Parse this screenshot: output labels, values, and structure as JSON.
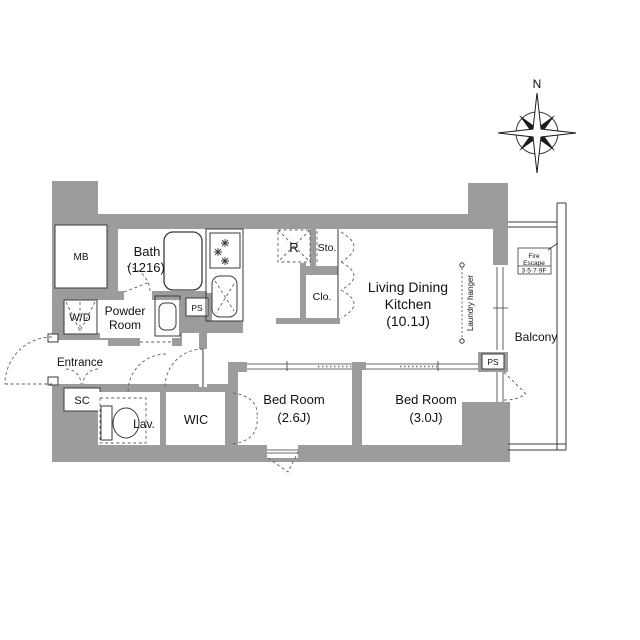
{
  "plan": {
    "rooms": {
      "mb": {
        "label": "MB"
      },
      "bath": {
        "label": "Bath",
        "size": "(1216)"
      },
      "powder_room": {
        "line1": "Powder",
        "line2": "Room"
      },
      "washer_dryer": {
        "label": "W/D"
      },
      "entrance": {
        "label": "Entrance"
      },
      "shoe_closet": {
        "label": "SC"
      },
      "lavatory": {
        "label": "Lav."
      },
      "walk_in_closet": {
        "label": "WIC"
      },
      "bedroom_small": {
        "label": "Bed Room",
        "size": "(2.6J)"
      },
      "bedroom_large": {
        "label": "Bed Room",
        "size": "(3.0J)"
      },
      "living_dining_kitchen": {
        "line1": "Living Dining",
        "line2": "Kitchen",
        "size": "(10.1J)"
      },
      "refrigerator": {
        "label": "R"
      },
      "storage": {
        "label": "Sto."
      },
      "closet": {
        "label": "Clo."
      },
      "pipe_space_left": {
        "label": "PS"
      },
      "pipe_space_right": {
        "label": "PS"
      },
      "balcony": {
        "label": "Balcony"
      }
    },
    "annotations": {
      "laundry_hanger": {
        "label": "Laundry hanger"
      },
      "fire_escape": {
        "line1": "Fire",
        "line2": "Escape",
        "line3": "3·5·7·9F"
      },
      "compass": {
        "north": "N"
      }
    },
    "colors": {
      "wall_fill": "#9c9c9c",
      "outline": "#3a3a3a",
      "background": "#ffffff"
    }
  }
}
